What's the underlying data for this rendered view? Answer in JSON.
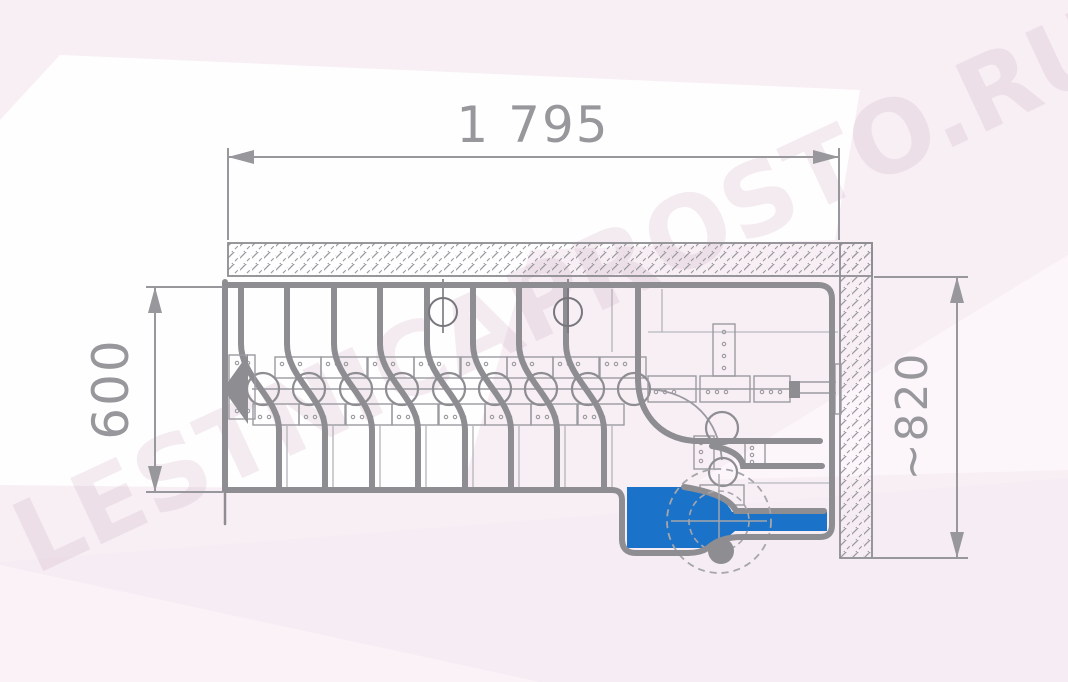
{
  "watermark": {
    "text": "LESTNICAPROSTO.RU"
  },
  "dimensions": {
    "top_width": {
      "label": "1 795"
    },
    "left_depth": {
      "label": "600"
    },
    "right_width": {
      "label": "~820"
    }
  },
  "stair": {
    "straight_steps": 9,
    "turn_joints": 2
  },
  "icons": {
    "direction_arrow": "left-filled-triangle"
  },
  "colors": {
    "line_gray": "#8d8d92",
    "thin_gray": "#a6a6ab",
    "accent_blue": "#1a73c8",
    "background_pink": "#f8eff5",
    "background_white": "#ffffff",
    "watermark_pink": "#b98fa8",
    "dim_text": "#97979c"
  }
}
